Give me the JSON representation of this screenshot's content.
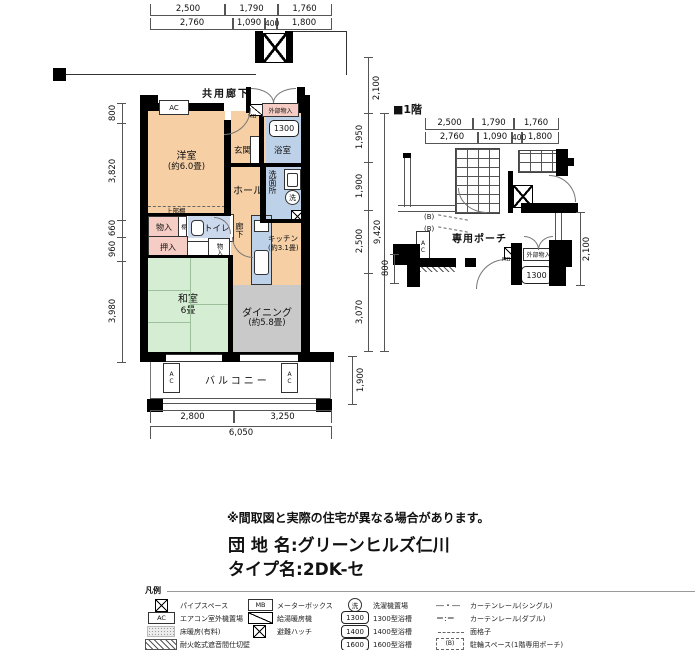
{
  "colors": {
    "wall": "#000000",
    "peach": "#f6cfa4",
    "blue": "#bdd1e8",
    "green": "#d5edd2",
    "gray": "#c9c9c9",
    "pink": "#f5cdc5"
  },
  "main_plan": {
    "corridor_label": "共用廊下",
    "balcony_label": "バルコニー",
    "ac_label": "AC",
    "rooms": {
      "western_name": "洋室",
      "western_size": "(約6.0畳)",
      "entrance": "玄関",
      "bath": "浴室",
      "bath_tub": "1300",
      "hall": "ホール",
      "washroom": "洗面所",
      "wash_machine": "洗",
      "upper_shelf": "上部棚",
      "storage_a": "物入",
      "shelf": "棚",
      "toilet": "トイレ",
      "closet": "押入",
      "storage_b": "物入",
      "corridor": "廊下",
      "kitchen_name": "キッチン",
      "kitchen_size": "(約3.1畳)",
      "japanese_name": "和室",
      "japanese_size": "6畳",
      "dining_name": "ダイニング",
      "dining_size": "(約5.8畳)",
      "ext_storage": "外部物入",
      "meter_box": "MB"
    },
    "dims": {
      "top1": [
        "2,500",
        "1,790",
        "1,760"
      ],
      "top2": [
        "2,760",
        "1,090",
        "400",
        "1,800"
      ],
      "left": [
        "800",
        "3,820",
        "660",
        "960",
        "3,980"
      ],
      "right_top": "2,100",
      "right": [
        "1,950",
        "1,900",
        "2,500",
        "3,070"
      ],
      "right_total": "9,420",
      "right_bottom": "1,900",
      "bottom": [
        "2,800",
        "3,250"
      ],
      "bottom_total": "6,050"
    }
  },
  "floor1": {
    "title": "■1階",
    "porch": "専用ポーチ",
    "bike_a": "(B)",
    "bike_b": "(B)",
    "ac_label": "AC",
    "ext_storage": "外部物入",
    "meter_box": "MB",
    "bath_tub": "1300",
    "dims": {
      "top1": [
        "2,500",
        "1,790",
        "1,760"
      ],
      "top2": [
        "2,760",
        "1,090",
        "400",
        "1,800"
      ],
      "right": "2,100",
      "left": "800"
    }
  },
  "notice": "※間取図と実際の住宅が異なる場合があります。",
  "names": {
    "estate_label": "団 地 名:",
    "estate_value": "グリーンヒルズ仁川",
    "type_label": "タイプ名:",
    "type_value": "2DK-セ"
  },
  "legend": {
    "title": "凡例",
    "col1": [
      {
        "symbol_text": "",
        "label": "パイプスペース"
      },
      {
        "symbol_text": "AC",
        "label": "エアコン室外機置場"
      },
      {
        "symbol_text": "",
        "label": "床暖房(有料)"
      },
      {
        "symbol_text": "",
        "label": "耐火乾式遮音間仕切壁"
      }
    ],
    "col2": [
      {
        "symbol_text": "MB",
        "label": "メーターボックス"
      },
      {
        "symbol_text": "",
        "label": "給湯暖房機"
      },
      {
        "symbol_text": "",
        "label": "避難ハッチ"
      }
    ],
    "col3": [
      {
        "symbol_text": "洗",
        "label": "洗濯機置場"
      },
      {
        "symbol_text": "1300",
        "label": "1300型浴槽"
      },
      {
        "symbol_text": "1400",
        "label": "1400型浴槽"
      },
      {
        "symbol_text": "1600",
        "label": "1600型浴槽"
      }
    ],
    "col4": [
      {
        "symbol_text": "―・―",
        "label": "カーテンレール(シングル)"
      },
      {
        "symbol_text": "＝:＝",
        "label": "カーテンレール(ダブル)"
      },
      {
        "symbol_text": "",
        "label": "面格子"
      },
      {
        "symbol_text": "(B)",
        "label": "駐輪スペース(1階専用ポーチ)"
      }
    ]
  }
}
